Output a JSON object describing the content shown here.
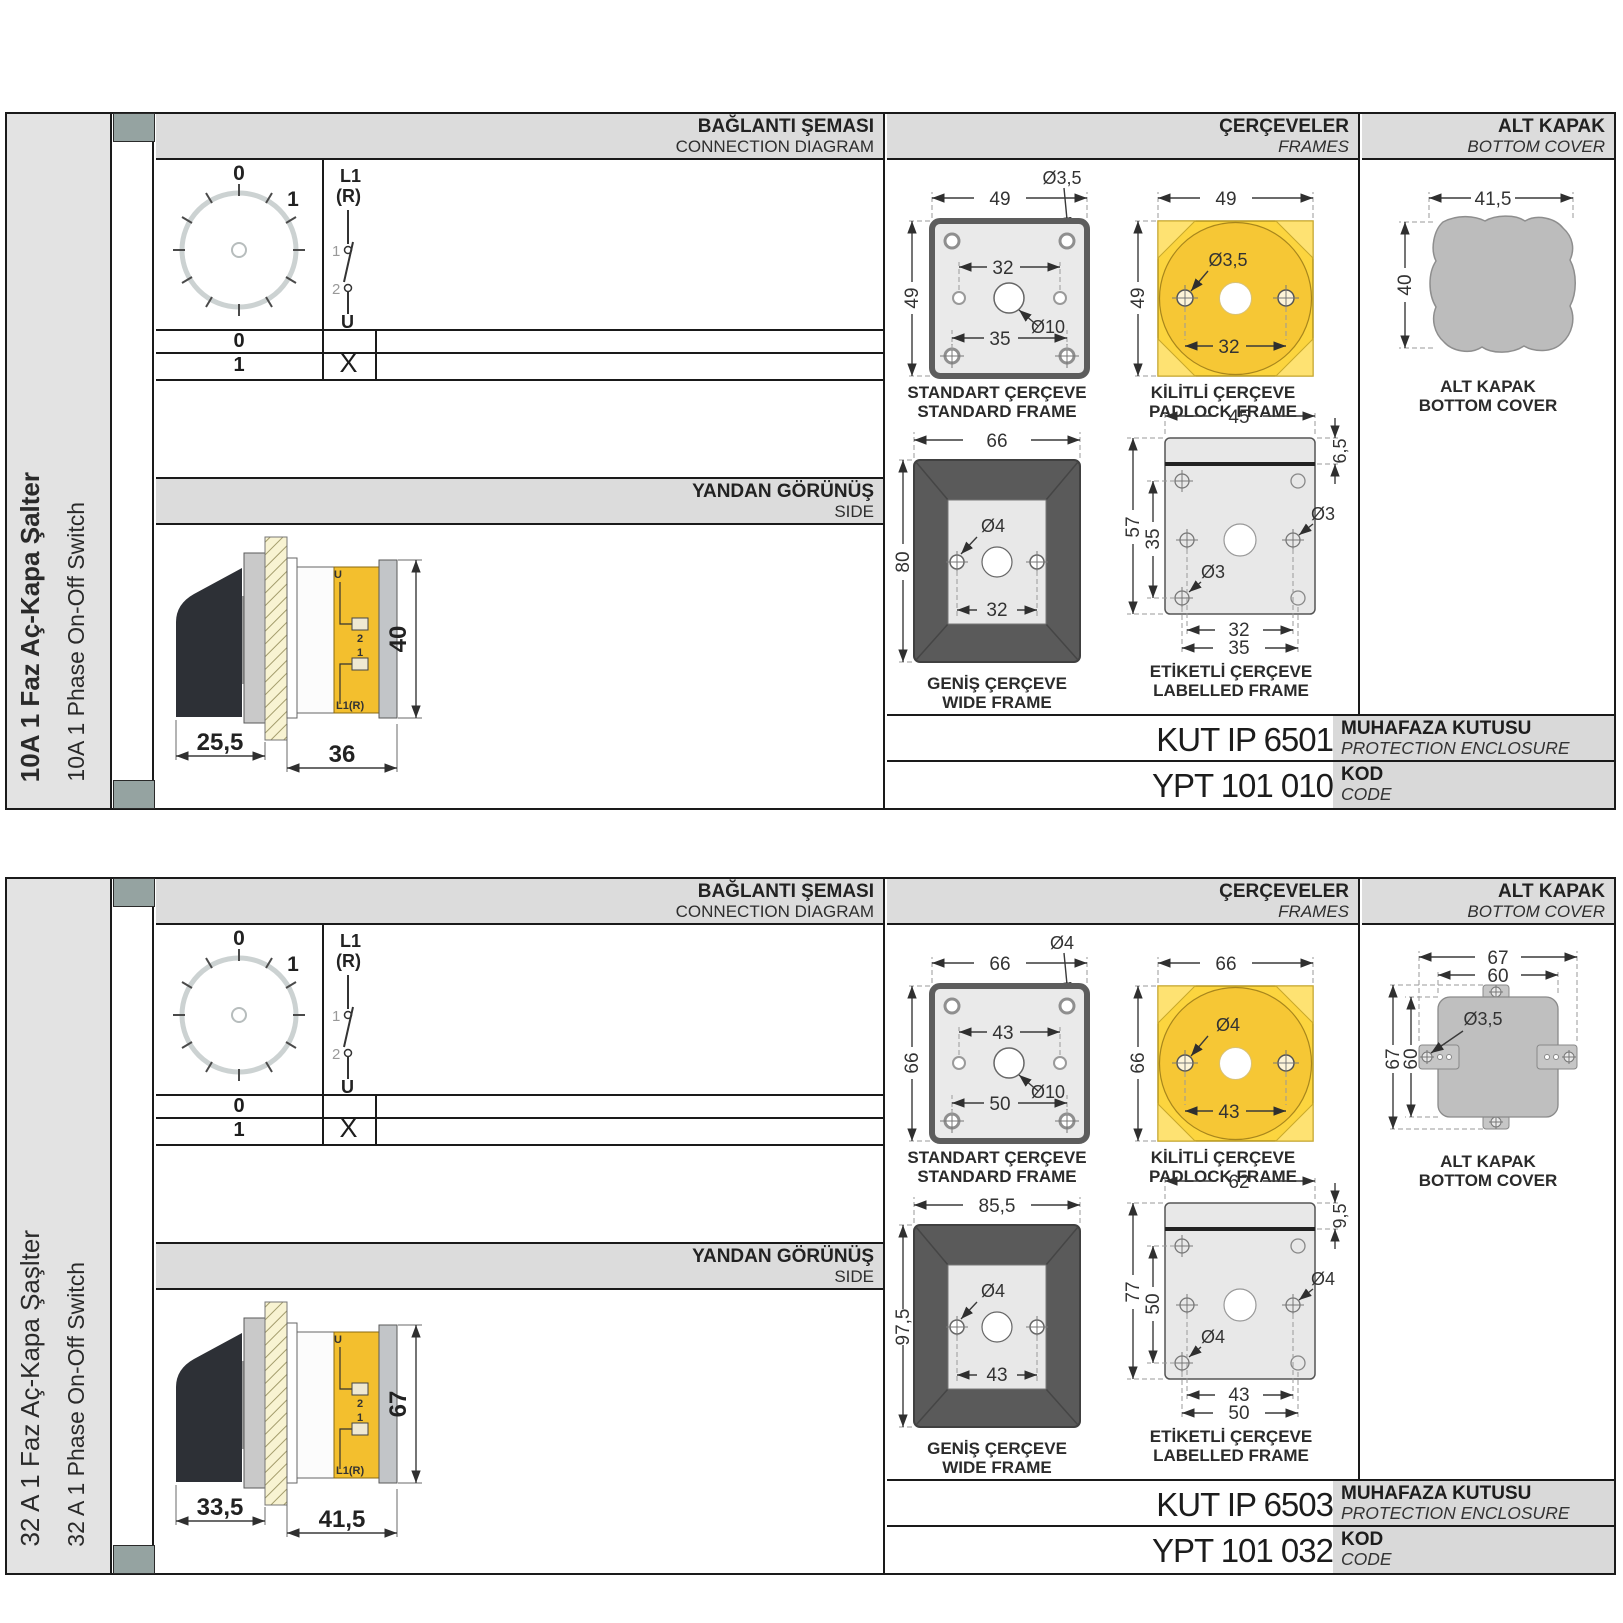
{
  "sections": [
    {
      "sidebar_title": "10A 1 Faz Aç-Kapa Şalter",
      "sidebar_subtitle": "10A 1 Phase On-Off Switch",
      "headers": {
        "diagram_tr": "BAĞLANTI ŞEMASI",
        "diagram_en": "CONNECTION DIAGRAM",
        "frames_tr": "ÇERÇEVELER",
        "frames_en": "FRAMES",
        "cover_tr": "ALT KAPAK",
        "cover_en": "BOTTOM COVER"
      },
      "dial": {
        "pos0": "0",
        "pos1": "1"
      },
      "schematic": {
        "l1": "L1",
        "r": "(R)",
        "c1": "1",
        "c2": "2",
        "u": "U"
      },
      "table": {
        "r0": "0",
        "r0_mark": "",
        "r1": "1",
        "r1_mark": "X"
      },
      "side_view": {
        "title_tr": "YANDAN GÖRÜNÜŞ",
        "title_en": "SIDE",
        "dim_knob": "25,5",
        "dim_body": "36",
        "dim_h": "40",
        "lbl_u": "U",
        "lbl_2": "2",
        "lbl_1": "1",
        "lbl_l1": "L1(R)"
      },
      "frames": {
        "standard": {
          "cap_tr": "STANDART ÇERÇEVE",
          "cap_en": "STANDARD FRAME",
          "dim_w": "49",
          "dim_h": "49",
          "hole": "Ø3,5",
          "inner": "32",
          "center": "Ø10",
          "bottom": "35"
        },
        "padlock": {
          "cap_tr": "KİLİTLİ ÇERÇEVE",
          "cap_en": "PADLOCK FRAME",
          "dim_w": "49",
          "dim_h": "49",
          "hole": "Ø3,5",
          "inner": "32"
        },
        "wide": {
          "cap_tr": "GENİŞ ÇERÇEVE",
          "cap_en": "WIDE FRAME",
          "dim_w": "66",
          "dim_h": "80",
          "hole": "Ø4",
          "inner": "32"
        },
        "labelled": {
          "cap_tr": "ETİKETLİ ÇERÇEVE",
          "cap_en": "LABELLED FRAME",
          "dim_w": "45",
          "band": "6,5",
          "dim_h": "57",
          "inner_h": "35",
          "hole_mid": "Ø3",
          "hole_bot": "Ø3",
          "b1": "32",
          "b2": "35"
        }
      },
      "cover": {
        "cap_tr": "ALT KAPAK",
        "cap_en": "BOTTOM COVER",
        "dim_w": "41,5",
        "dim_h": "40"
      },
      "codes": {
        "enclosure_value": "KUT IP 6501",
        "enclosure_tr": "MUHAFAZA KUTUSU",
        "enclosure_en": "PROTECTION ENCLOSURE",
        "code_value": "YPT 101 010",
        "code_tr": "KOD",
        "code_en": "CODE"
      }
    },
    {
      "sidebar_title": "32 A 1 Faz Aç-Kapa Şaşlter",
      "sidebar_subtitle": "32 A 1 Phase On-Off Switch",
      "headers": {
        "diagram_tr": "BAĞLANTI ŞEMASI",
        "diagram_en": "CONNECTION DIAGRAM",
        "frames_tr": "ÇERÇEVELER",
        "frames_en": "FRAMES",
        "cover_tr": "ALT KAPAK",
        "cover_en": "BOTTOM COVER"
      },
      "dial": {
        "pos0": "0",
        "pos1": "1"
      },
      "schematic": {
        "l1": "L1",
        "r": "(R)",
        "c1": "1",
        "c2": "2",
        "u": "U"
      },
      "table": {
        "r0": "0",
        "r0_mark": "",
        "r1": "1",
        "r1_mark": "X"
      },
      "side_view": {
        "title_tr": "YANDAN GÖRÜNÜŞ",
        "title_en": "SIDE",
        "dim_knob": "33,5",
        "dim_body": "41,5",
        "dim_h": "67",
        "lbl_u": "U",
        "lbl_2": "2",
        "lbl_1": "1",
        "lbl_l1": "L1(R)"
      },
      "frames": {
        "standard": {
          "cap_tr": "STANDART ÇERÇEVE",
          "cap_en": "STANDARD FRAME",
          "dim_w": "66",
          "dim_h": "66",
          "hole": "Ø4",
          "inner": "43",
          "center": "Ø10",
          "bottom": "50"
        },
        "padlock": {
          "cap_tr": "KİLİTLİ ÇERÇEVE",
          "cap_en": "PADLOCK FRAME",
          "dim_w": "66",
          "dim_h": "66",
          "hole": "Ø4",
          "inner": "43"
        },
        "wide": {
          "cap_tr": "GENİŞ ÇERÇEVE",
          "cap_en": "WIDE FRAME",
          "dim_w": "85,5",
          "dim_h": "97,5",
          "hole": "Ø4",
          "inner": "43"
        },
        "labelled": {
          "cap_tr": "ETİKETLİ ÇERÇEVE",
          "cap_en": "LABELLED FRAME",
          "dim_w": "62",
          "band": "9,5",
          "dim_h": "77",
          "inner_h": "50",
          "hole_mid": "Ø4",
          "hole_bot": "Ø4",
          "b1": "43",
          "b2": "50"
        }
      },
      "cover": {
        "cap_tr": "ALT KAPAK",
        "cap_en": "BOTTOM COVER",
        "dim_w": "67",
        "dim_w2": "60",
        "dim_h": "67",
        "dim_h2": "60",
        "hole": "Ø3,5"
      },
      "codes": {
        "enclosure_value": "KUT IP 6503",
        "enclosure_tr": "MUHAFAZA KUTUSU",
        "enclosure_en": "PROTECTION ENCLOSURE",
        "code_value": "YPT 101 032",
        "code_tr": "KOD",
        "code_en": "CODE"
      }
    }
  ]
}
